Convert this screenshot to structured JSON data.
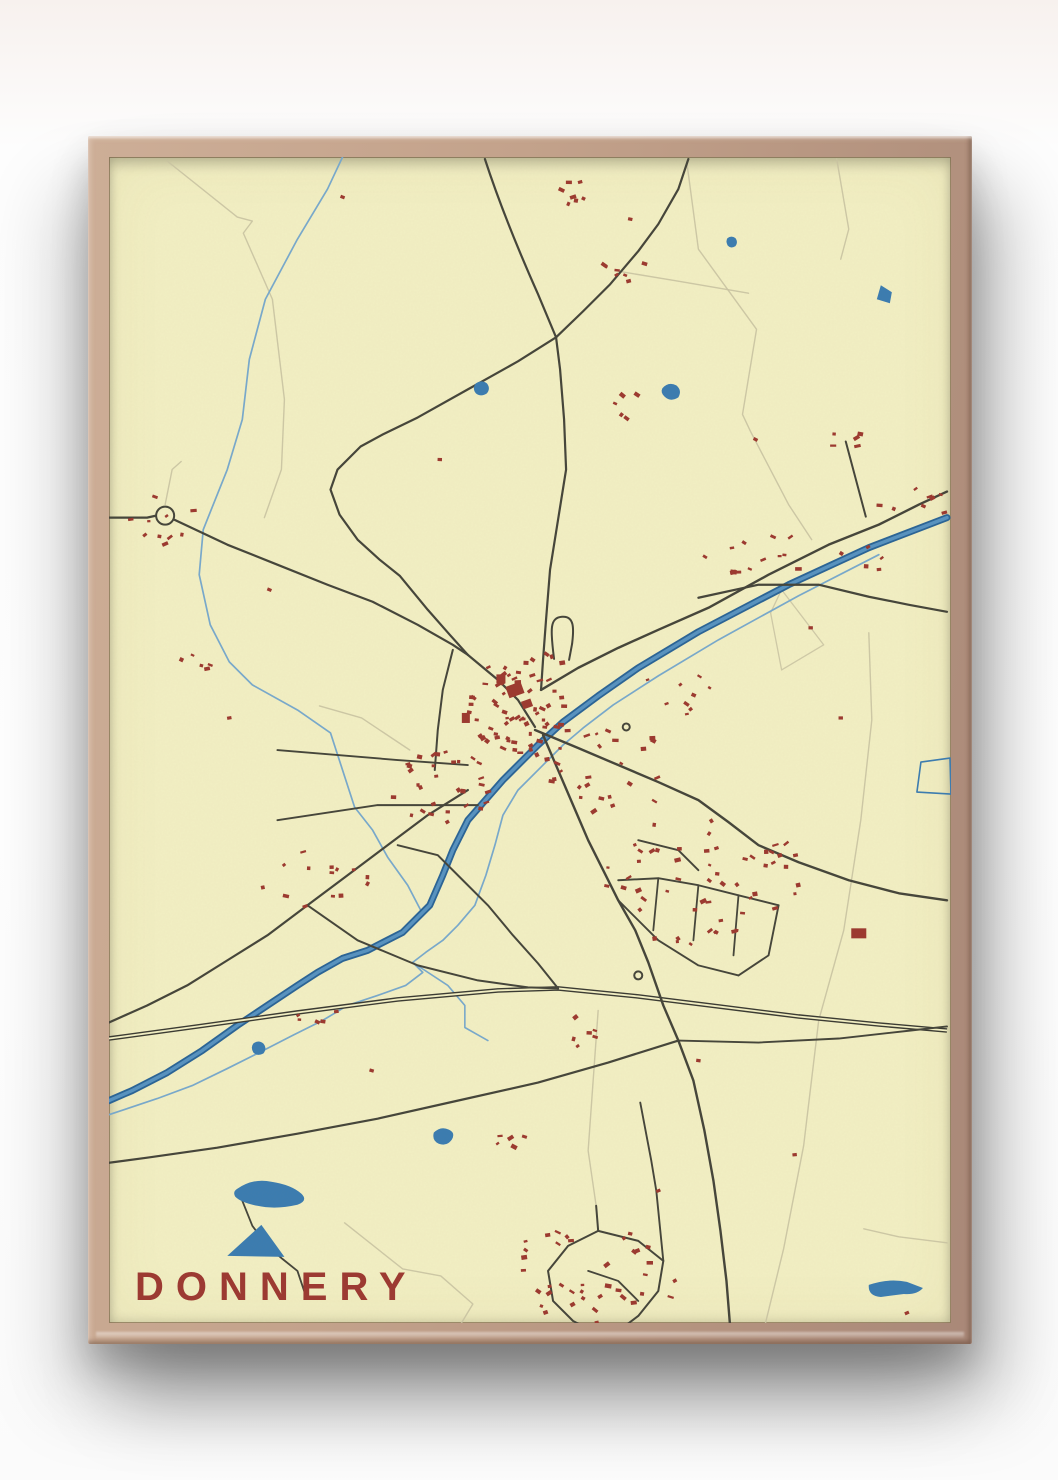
{
  "poster": {
    "title": "DONNERY"
  },
  "colors": {
    "paper": "#f2efc3",
    "road": "#45453a",
    "rail": "#3a3a32",
    "tan": "#c9c3a2",
    "canal_casing": "#2a6496",
    "canal_core": "#5792c0",
    "stream": "#78a9cc",
    "pond": "#3b7cb0",
    "building": "#9c392f",
    "title": "#9c3a32",
    "frame_light": "#cdae97",
    "frame_dark": "#a98878"
  },
  "map": {
    "width": 840,
    "height": 1164,
    "features": [
      {
        "k": "path",
        "s": "tan",
        "w": 1.4,
        "o": 0.9,
        "d": "M58,4 L128,60 L143,64 L134,76 L163,142 L175,242 L172,312 L155,360"
      },
      {
        "k": "path",
        "s": "tan",
        "w": 1.4,
        "o": 0.9,
        "d": "M576,2 L588,92 L646,172 L632,257 L640,274 L678,347 L701,382"
      },
      {
        "k": "path",
        "s": "tan",
        "w": 1.4,
        "o": 0.9,
        "d": "M508,114 L568,124 L638,136"
      },
      {
        "k": "path",
        "s": "tan",
        "w": 1.4,
        "o": 0.9,
        "d": "M726,2 L738,72 L730,102"
      },
      {
        "k": "path",
        "s": "tan",
        "w": 1.4,
        "o": 0.9,
        "d": "M758,475 L761,562 L750,662 L733,772 L708,862 L693,987 L673,1090 L653,1172"
      },
      {
        "k": "path",
        "s": "tan",
        "w": 1.4,
        "o": 0.9,
        "d": "M753,1070 L788,1078 L836,1084"
      },
      {
        "k": "path",
        "s": "tan",
        "w": 1.4,
        "o": 0.9,
        "d": "M235,1064 L293,1110 L331,1117 L363,1145 L348,1170"
      },
      {
        "k": "path",
        "s": "tan",
        "w": 1.4,
        "o": 0.9,
        "d": "M56,347 L63,312 L72,304"
      },
      {
        "k": "path",
        "s": "tan",
        "w": 1.4,
        "o": 0.9,
        "d": "M488,852 L483,922 L478,992 L486,1047"
      },
      {
        "k": "path",
        "s": "tan",
        "w": 1.4,
        "o": 0.9,
        "d": "M300,592 L252,560 L210,548"
      },
      {
        "k": "path",
        "s": "tan",
        "w": 1.3,
        "o": 0.85,
        "d": "M671,432 L713,487 L671,512 L660,455 Z"
      },
      {
        "k": "path",
        "s": "stream",
        "w": 1.7,
        "d": "M233,0 L218,32 L188,82 L156,142 L140,202 L133,262 L118,312 L94,372 L90,417 L101,467 L120,504 L143,527 L188,552 L221,575 L245,649 L263,672 L278,699 L298,727 L311,752"
      },
      {
        "k": "path",
        "s": "stream",
        "w": 1.7,
        "d": "M768,397 L688,438 L608,482 L548,518 L503,547 L473,570 L453,587 L433,607 L408,632 L393,657 L385,687 L376,717 L365,747 L348,767 L333,782 L316,794 L303,804 L313,814 L296,827 L268,837 L238,847 L213,862 L183,877 L150,894 L118,910 L83,927 L48,940 L18,950 L0,956"
      },
      {
        "k": "path",
        "s": "stream",
        "w": 1.6,
        "d": "M303,804 L338,827 L355,847 L355,869 L378,882"
      },
      {
        "k": "canal",
        "d": "M836,360 L758,390 L678,427 L588,474 L528,510 L488,538 L453,564 L428,587 L393,622 L358,662 L343,692 L333,717 L320,747 L293,774 L258,792 L233,800 L208,814 L188,827 L158,847 L128,867 L93,892 L58,914 L23,932 L0,942"
      },
      {
        "k": "rail",
        "d": "M0,880 L88,868 L188,854 L288,841 L388,832 L448,830 L528,838 L608,848 L688,858 L768,866 L836,872"
      },
      {
        "k": "path",
        "s": "road",
        "w": 2.2,
        "d": "M375,2 C388,42 408,92 428,137 L446,180"
      },
      {
        "k": "path",
        "s": "road",
        "w": 2.2,
        "d": "M446,180 L473,154 L500,127 L528,94 L548,67 L568,32 L578,2"
      },
      {
        "k": "path",
        "s": "road",
        "w": 2.2,
        "d": "M446,180 L408,204 L358,232 L308,260 L273,277 L251,289 L228,312 L221,332 L230,357 L248,382 L270,402 L290,418 L318,452 L340,477 L358,497"
      },
      {
        "k": "path",
        "s": "road",
        "w": 2.2,
        "d": "M446,180 L450,212 L454,262 L456,312 L448,362 L440,412 L436,462 L433,502 L431,532"
      },
      {
        "k": "path",
        "s": "road",
        "w": 2.2,
        "d": "M0,360 L38,360 L47,358 L65,362 L118,387 L168,407 L218,427 L263,444 L308,467 L343,487 L358,497 L388,522 L408,542 L425,569"
      },
      {
        "k": "path",
        "s": "road",
        "w": 2.4,
        "d": "M431,532 L468,510 L508,490 L548,472 L598,450 L658,417 L718,387 L768,367 L808,347 L836,334"
      },
      {
        "k": "path",
        "s": "road",
        "w": 2.2,
        "d": "M588,440 L648,427 L708,427 L758,439 L798,447 L836,454"
      },
      {
        "k": "path",
        "s": "road",
        "w": 2,
        "d": "M735,284 L755,359"
      },
      {
        "k": "path",
        "s": "road",
        "w": 2.4,
        "d": "M425,572 L468,590 L508,607 L548,624 L588,642 L618,664 L648,687 L688,704 L738,722 L788,735 L836,742"
      },
      {
        "k": "path",
        "s": "road",
        "w": 2.4,
        "d": "M433,577 L448,612 L463,647 L478,682 L493,712 L508,742 L525,772 L538,804 L553,847 L568,882 L583,922 L594,972 L603,1022 L610,1072 L616,1122 L620,1172"
      },
      {
        "k": "path",
        "s": "road",
        "w": 2,
        "d": "M343,492 L333,532 L328,572 L325,612"
      },
      {
        "k": "path",
        "s": "road",
        "w": 1.9,
        "d": "M168,592 L288,602 L358,607"
      },
      {
        "k": "path",
        "s": "road",
        "w": 1.9,
        "d": "M168,662 L268,647 L368,647"
      },
      {
        "k": "path",
        "s": "road",
        "w": 2.2,
        "d": "M358,632 L318,657 L278,687 L238,717 L198,747 L158,777 L118,802 L78,827 L38,847 L0,864"
      },
      {
        "k": "path",
        "s": "road",
        "w": 2,
        "d": "M198,747 L248,782 L308,807 L368,822 L418,829 L448,830"
      },
      {
        "k": "path",
        "s": "road",
        "w": 2,
        "d": "M288,687 L328,697 L353,722 L378,747 L403,777 L428,805 L448,830"
      },
      {
        "k": "path",
        "s": "road",
        "w": 2.2,
        "d": "M568,882 L498,904 L428,924 L348,942 L268,960 L188,975 L108,989 L38,999 L0,1004"
      },
      {
        "k": "path",
        "s": "road",
        "w": 1.9,
        "d": "M568,882 L648,884 L728,880 L800,872 L836,868"
      },
      {
        "k": "path",
        "s": "road",
        "w": 1.8,
        "d": "M133,1042 L143,1067 L158,1087 L173,1100 L188,1112 L196,1136"
      },
      {
        "k": "path",
        "s": "road",
        "w": 2,
        "d": "M444,501 C440,470 440,460 452,459 C464,458 464,470 462,486 L459,502"
      },
      {
        "k": "path",
        "s": "road",
        "w": 1.9,
        "d": "M508,722 L548,720 L588,727 L628,737 L668,747"
      },
      {
        "k": "path",
        "s": "road",
        "w": 1.9,
        "d": "M528,682 L568,692 L588,712"
      },
      {
        "k": "path",
        "s": "road",
        "w": 1.8,
        "d": "M548,720 L543,772"
      },
      {
        "k": "path",
        "s": "road",
        "w": 1.8,
        "d": "M588,727 L583,782"
      },
      {
        "k": "path",
        "s": "road",
        "w": 1.8,
        "d": "M628,737 L623,797"
      },
      {
        "k": "path",
        "s": "road",
        "w": 1.9,
        "d": "M508,742 L548,782 L588,807 L628,817"
      },
      {
        "k": "path",
        "s": "road",
        "w": 1.9,
        "d": "M628,817 L658,797 L668,747"
      },
      {
        "k": "path",
        "s": "road",
        "w": 2,
        "d": "M486,1047 L488,1072 L458,1087 L438,1112 L443,1142 L463,1162 L482,1172"
      },
      {
        "k": "path",
        "s": "road",
        "w": 2,
        "d": "M488,1072 L528,1082 L553,1102 L548,1132 L528,1157 L508,1172"
      },
      {
        "k": "path",
        "s": "road",
        "w": 1.8,
        "d": "M478,1112 L508,1122 L528,1142"
      },
      {
        "k": "path",
        "s": "road",
        "w": 1.9,
        "d": "M530,944 L541,1002 L546,1032 L550,1072 L553,1102"
      },
      {
        "k": "circle",
        "x": 56,
        "y": 358,
        "r": 9
      },
      {
        "k": "circle",
        "x": 528,
        "y": 817,
        "r": 4
      },
      {
        "k": "circle",
        "x": 516,
        "y": 569,
        "r": 3.5
      },
      {
        "k": "area",
        "s": "pond",
        "d": "M770,128 l11,7 -2,11 -13,-4 z"
      },
      {
        "k": "area",
        "s": "pond",
        "d": "M552,231 q6,-7 14,-3 q6,5 2,12 q-8,5 -14,-1 q-4,-4 -2,-8 z"
      },
      {
        "k": "area",
        "s": "pond",
        "d": "M366,226 q6,-4 11,0 q4,5 0,10 q-6,4 -11,0 q-4,-5 0,-10 z"
      },
      {
        "k": "area",
        "s": "pond",
        "d": "M617,81 q4,-3 8,0 q3,4 0,8 q-5,3 -8,-1 q-2,-4 0,-7 z"
      },
      {
        "k": "area",
        "s": "pond",
        "d": "M144,885 q5,-4 10,0 q4,5 0,10 q-6,3 -10,-1 q-3,-5 0,-9 z"
      },
      {
        "k": "area",
        "s": "pond",
        "d": "M324,974 q7,-7 15,-3 q7,3 3,10 q-5,7 -13,4 q-7,-3 -5,-11 z"
      },
      {
        "k": "area",
        "s": "pond",
        "d": "M128,1030 q16,-11 34,-7 q20,3 30,12 q7,7 -4,11 q-22,5 -40,1 q-16,-3 -22,-9 q-3,-5 2,-8 z"
      },
      {
        "k": "area",
        "s": "pond",
        "d": "M118,1097 L175,1098 L152,1066 Z"
      },
      {
        "k": "area",
        "s": "pond",
        "d": "M758,1126 q20,-7 38,-3 l16,6 q-6,7 -19,6 l-23,3 q-13,-1 -12,-12 z"
      },
      {
        "k": "path",
        "s": "pond",
        "w": 1.6,
        "d": "M810,604 L839,600 L840,636 L806,634 Z"
      }
    ],
    "clusters": [
      [
        413,
        557,
        60,
        42,
        52
      ],
      [
        338,
        632,
        55,
        45,
        30
      ],
      [
        418,
        514,
        48,
        20,
        14
      ],
      [
        498,
        612,
        65,
        45,
        26
      ],
      [
        588,
        722,
        100,
        65,
        48
      ],
      [
        488,
        1112,
        85,
        58,
        38
      ],
      [
        218,
        722,
        70,
        35,
        14
      ],
      [
        53,
        362,
        36,
        28,
        10
      ],
      [
        73,
        507,
        28,
        12,
        5
      ],
      [
        688,
        400,
        95,
        22,
        18
      ],
      [
        803,
        347,
        42,
        20,
        8
      ],
      [
        518,
        114,
        30,
        22,
        7
      ],
      [
        518,
        250,
        20,
        16,
        5
      ],
      [
        463,
        37,
        25,
        14,
        6
      ],
      [
        468,
        872,
        26,
        16,
        6
      ],
      [
        400,
        982,
        20,
        9,
        5
      ],
      [
        678,
        702,
        45,
        18,
        7
      ],
      [
        568,
        532,
        40,
        25,
        9
      ],
      [
        738,
        282,
        20,
        12,
        5
      ],
      [
        210,
        860,
        25,
        10,
        5
      ]
    ],
    "buildings": [
      [
        405,
        532,
        16,
        12,
        -20
      ],
      [
        417,
        546,
        10,
        8,
        -20
      ],
      [
        391,
        521,
        9,
        9,
        0
      ],
      [
        748,
        775,
        15,
        10,
        0
      ],
      [
        356,
        560,
        8,
        10,
        0
      ]
    ],
    "singles": [
      [
        233,
        40
      ],
      [
        470,
        25
      ],
      [
        520,
        62
      ],
      [
        645,
        282
      ],
      [
        160,
        432
      ],
      [
        120,
        560
      ],
      [
        588,
        902
      ],
      [
        684,
        996
      ],
      [
        796,
        1154
      ],
      [
        548,
        1032
      ],
      [
        606,
        690
      ],
      [
        730,
        560
      ],
      [
        262,
        912
      ],
      [
        330,
        302
      ],
      [
        700,
        470
      ]
    ]
  }
}
